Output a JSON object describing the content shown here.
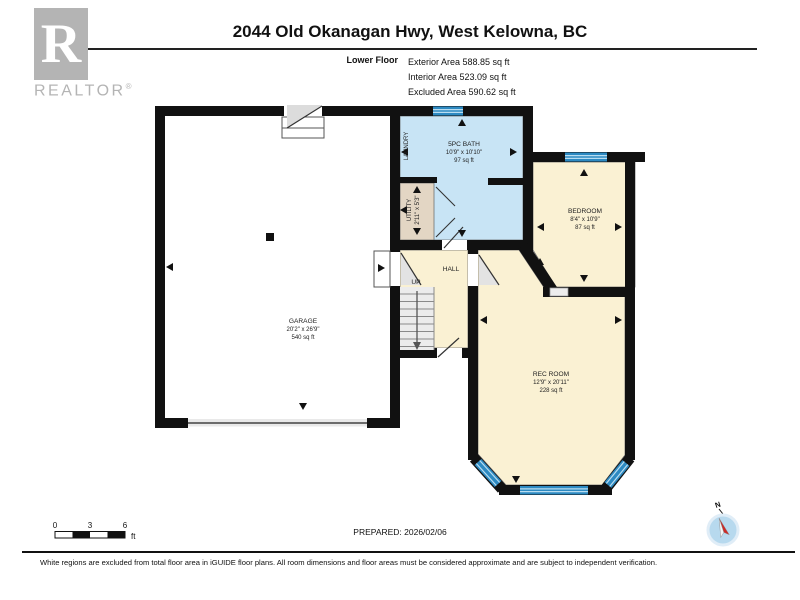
{
  "header": {
    "title": "2044 Old Okanagan Hwy, West Kelowna, BC",
    "floor_label": "Lower Floor",
    "exterior_area": "Exterior Area 588.85 sq ft",
    "interior_area": "Interior Area 523.09 sq ft",
    "excluded_area": "Excluded Area 590.62 sq ft"
  },
  "logo": {
    "letter": "R",
    "brand": "REALTOR",
    "registered": "®"
  },
  "plan": {
    "garage": {
      "name": "GARAGE",
      "dims": "20'2\" x 26'9\"",
      "area": "540 sq ft"
    },
    "bath": {
      "name": "5PC BATH",
      "dims": "10'9\" x 10'10\"",
      "area": "97 sq ft"
    },
    "laundry": {
      "name": "LAUNDRY"
    },
    "utility": {
      "name": "UTILITY",
      "dims": "2'11\" x 5'3\""
    },
    "hall": {
      "name": "HALL",
      "up_label": "UP"
    },
    "bedroom": {
      "name": "BEDROOM",
      "dims": "8'4\" x 10'9\"",
      "area": "87 sq ft"
    },
    "rec_room": {
      "name": "REC ROOM",
      "dims": "12'9\" x 20'11\"",
      "area": "228 sq ft"
    }
  },
  "footer": {
    "scale_zero": "0",
    "scale_three": "3",
    "scale_six": "6",
    "scale_unit": "ft",
    "prepared": "PREPARED: 2026/02/06",
    "disclaimer": "White regions are excluded from total floor area in iGUIDE floor plans. All room dimensions and floor areas must be considered approximate and are subject to independent verification.",
    "compass_north": "N"
  },
  "colors": {
    "wall": "#111111",
    "bath_fill": "#c8e4f5",
    "room_fill": "#faf1d3",
    "utility_fill": "#e3d6c4",
    "window_blue": "#2d8ac2",
    "compass_fill": "#b7d9ee",
    "needle_red": "#cc2a27",
    "logo_gray": "#b4b4b4"
  }
}
